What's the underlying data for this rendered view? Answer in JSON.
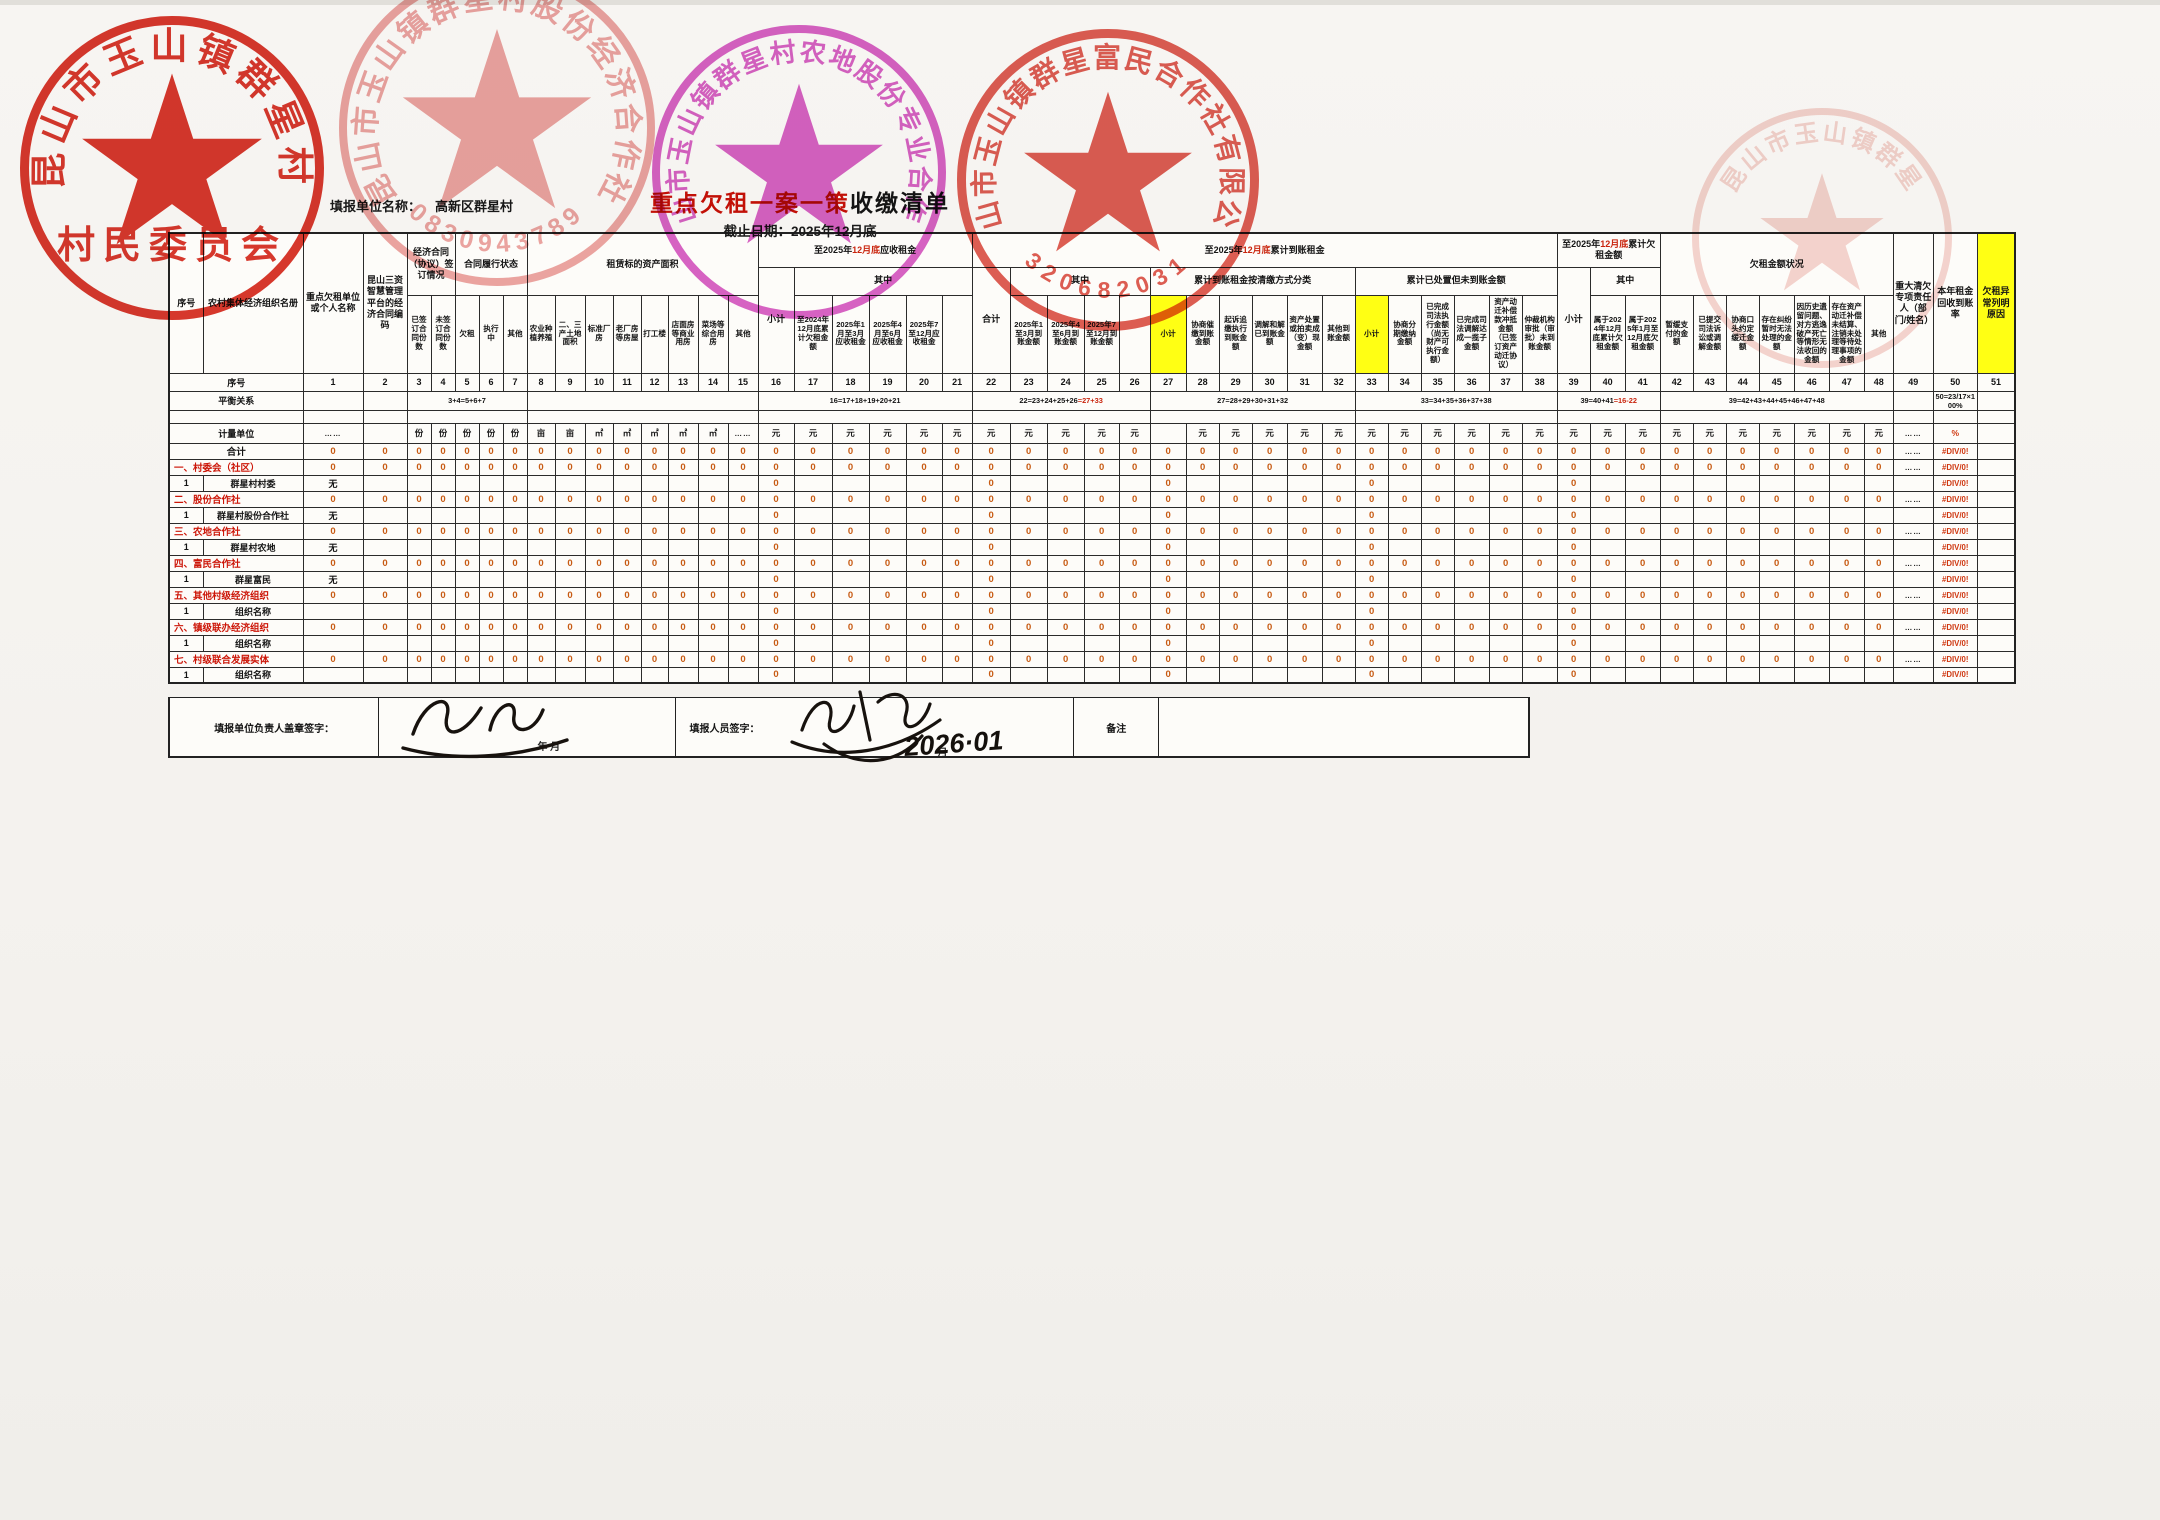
{
  "document": {
    "title_red": "重点欠租一案一策",
    "title_black": "收缴清单",
    "deadline": "截止日期：2025年12月底",
    "unit_label": "填报单位名称：",
    "unit_value": "高新区群星村"
  },
  "stamps": [
    {
      "name": "village-committee-stamp",
      "top": "昆山市玉山镇群星村",
      "bottom": "村民委员会",
      "color": "#d5281c",
      "opacity": 0.92
    },
    {
      "name": "share-cooperative-stamp",
      "top": "昆山市玉山镇群星村股份经济合作社",
      "bottom": "0830943789",
      "color": "#e06a66",
      "opacity": 0.6
    },
    {
      "name": "farmland-cooperative-stamp",
      "top": "昆山市玉山镇群星村农地股份专业合作社",
      "bottom": "",
      "color": "#cb2fb4",
      "opacity": 0.75
    },
    {
      "name": "fumin-cooperative-stamp",
      "top": "昆山市玉山镇群星富民合作社有限公司",
      "bottom": "320682031",
      "color": "#d6362a",
      "opacity": 0.8
    },
    {
      "name": "faint-partial-stamp",
      "top": "昆山市玉山镇群星",
      "bottom": "",
      "color": "#d8584a",
      "opacity": 0.25
    }
  ],
  "table": {
    "lead": [
      "序号",
      "农村集体经济组织名册"
    ],
    "row_labels": {
      "serial": "序号",
      "balance": "平衡关系",
      "units": "计量单位",
      "total": "合计"
    },
    "header_row1": [
      {
        "t": "序号",
        "rs": 3
      },
      {
        "t": "农村集体经济组织名册",
        "rs": 3
      },
      {
        "t": "重点欠租单位或个人名称",
        "rs": 3
      },
      {
        "t": "昆山三资智慧管理平台的经济合同编码",
        "rs": 3
      },
      {
        "t": "经济合同（协议）签订情况",
        "cs": 2,
        "rs": 2
      },
      {
        "t": "合同履行状态",
        "cs": 3,
        "rs": 2
      },
      {
        "t": "租赁标的资产面积",
        "cs": 8,
        "rs": 2
      },
      {
        "p": [
          [
            "至2025年",
            0
          ],
          [
            "12月底",
            1
          ],
          [
            "应收租金",
            0
          ]
        ],
        "cs": 6
      },
      {
        "p": [
          [
            "至2025年",
            0
          ],
          [
            "12月底",
            1
          ],
          [
            "累计到账租金",
            0
          ]
        ],
        "cs": 17
      },
      {
        "p": [
          [
            "至2025年",
            0
          ],
          [
            "12月底",
            1
          ],
          [
            "累计欠租金额",
            0
          ]
        ],
        "cs": 3
      },
      {
        "t": "欠租金额状况",
        "cs": 7,
        "rs": 2
      },
      {
        "t": "重大清欠专项责任人（部门/姓名）",
        "rs": 3
      },
      {
        "t": "本年租金回收到账率",
        "rs": 3
      },
      {
        "t": "欠租异常列明原因",
        "rs": 3,
        "y": 1
      }
    ],
    "header_row2": [
      {
        "t": "小计",
        "rs": 2
      },
      {
        "t": "其中",
        "cs": 5
      },
      {
        "t": "合计",
        "rs": 2
      },
      {
        "t": "其中",
        "cs": 4
      },
      {
        "t": "累计到账租金按清缴方式分类",
        "cs": 6
      },
      {
        "t": "累计已处置但未到账金额",
        "cs": 6
      },
      {
        "t": "小计",
        "rs": 2
      },
      {
        "t": "其中",
        "cs": 2
      }
    ],
    "header_row3": [
      {
        "t": "已签订合同份数"
      },
      {
        "t": "未签订合同份数"
      },
      {
        "t": "欠租"
      },
      {
        "t": "执行中"
      },
      {
        "t": "其他"
      },
      {
        "t": "农业种植养殖"
      },
      {
        "t": "二、三产土地面积"
      },
      {
        "t": "标准厂房"
      },
      {
        "t": "老厂房等房屋"
      },
      {
        "t": "打工楼"
      },
      {
        "t": "店面房等商业用房"
      },
      {
        "t": "菜场等综合用房"
      },
      {
        "t": "其他"
      },
      {
        "t": "至2024年12月底累计欠租金额"
      },
      {
        "t": "2025年1月至3月应收租金"
      },
      {
        "t": "2025年4月至6月应收租金"
      },
      {
        "t": "2025年7至12月应收租金"
      },
      {
        "t": ""
      },
      {
        "t": "2025年1至3月到账金额"
      },
      {
        "t": "2025年4至6月到账金额"
      },
      {
        "t": "2025年7至12月到账金额"
      },
      {
        "t": ""
      },
      {
        "t": "小计",
        "y": 1
      },
      {
        "t": "协商催缴到账金额"
      },
      {
        "t": "起诉追缴执行到账金额"
      },
      {
        "t": "调解和解已到账金额"
      },
      {
        "t": "资产处置或拍卖成（变）现金额"
      },
      {
        "t": "其他到账金额"
      },
      {
        "t": "小计",
        "y": 1
      },
      {
        "t": "协商分期缴纳金额"
      },
      {
        "t": "已完成司法执行金额（尚无财产可执行金额）"
      },
      {
        "t": "已完成司法调解达成一揽子金额"
      },
      {
        "t": "资产动迁补偿款冲抵金额（已签订资产动迁协议）"
      },
      {
        "t": "仲裁机构审批（审批）未到账金额"
      },
      {
        "t": "属于2024年12月底累计欠租金额"
      },
      {
        "t": "属于2025年1月至12月底欠租金额"
      },
      {
        "t": "暂缓支付的金额"
      },
      {
        "t": "已提交司法诉讼或调解金额"
      },
      {
        "t": "协商口头约定缓迁金额"
      },
      {
        "t": "存在纠纷暂时无法处理的金额"
      },
      {
        "t": "因历史遗留问题、对方逃逸破产死亡等情形无法收回的金额"
      },
      {
        "t": "存在资产动迁补偿未结算、注销未处理等待处理事项的金额"
      },
      {
        "t": "其他"
      }
    ],
    "units": [
      "……",
      "",
      "份",
      "份",
      "份",
      "份",
      "份",
      "亩",
      "亩",
      "㎡",
      "㎡",
      "㎡",
      "㎡",
      "㎡",
      "……",
      "元",
      "元",
      "元",
      "元",
      "元",
      "元",
      "元",
      "元",
      "元",
      "元",
      "元",
      "",
      "元",
      "元",
      "元",
      "元",
      "元",
      "元",
      "元",
      "元",
      "元",
      "元",
      "元",
      "元",
      "元",
      "元",
      "元",
      "元",
      "元",
      "元",
      "元",
      "元",
      "元",
      "……",
      "%",
      ""
    ],
    "balance": [
      {
        "s": 1
      },
      {
        "s": 1
      },
      {
        "s": 5,
        "b": "3+4=5+6+7"
      },
      {
        "s": 8
      },
      {
        "s": 6,
        "b": "16=17+18+19+20+21"
      },
      {
        "s": 5,
        "b": "22=23+24+25+26",
        "r": "=27+33"
      },
      {
        "s": 6,
        "b": "27=28+29+30+31+32"
      },
      {
        "s": 6,
        "b": "33=34+35+36+37+38"
      },
      {
        "s": 3,
        "b": "39=40+41",
        "r": "=16-22"
      },
      {
        "s": 7,
        "b": "39=42+43+44+45+46+47+48"
      },
      {
        "s": 1
      },
      {
        "s": 1,
        "b": "50=23/17×100%"
      },
      {
        "s": 1
      }
    ],
    "subtotal_cols": [
      16,
      22,
      27,
      33,
      39
    ],
    "zero": "0",
    "dash": "……",
    "div0": "#DIV/0!",
    "rows": [
      {
        "k": "total",
        "label": "合计"
      },
      {
        "k": "cat",
        "label": "一、村委会（社区）"
      },
      {
        "k": "sub",
        "seq": "1",
        "org": "群星村村委",
        "name": "无"
      },
      {
        "k": "cat",
        "label": "二、股份合作社"
      },
      {
        "k": "sub",
        "seq": "1",
        "org": "群星村股份合作社",
        "name": "无"
      },
      {
        "k": "cat",
        "label": "三、农地合作社"
      },
      {
        "k": "sub",
        "seq": "1",
        "org": "群星村农地",
        "name": "无"
      },
      {
        "k": "cat",
        "label": "四、富民合作社"
      },
      {
        "k": "sub",
        "seq": "1",
        "org": "群星富民",
        "name": "无"
      },
      {
        "k": "cat",
        "label": "五、其他村级经济组织"
      },
      {
        "k": "sub",
        "seq": "1",
        "org": "组织名称",
        "name": ""
      },
      {
        "k": "cat",
        "label": "六、镇级联办经济组织"
      },
      {
        "k": "sub",
        "seq": "1",
        "org": "组织名称",
        "name": ""
      },
      {
        "k": "cat",
        "label": "七、村级联合发展实体"
      },
      {
        "k": "sub",
        "seq": "1",
        "org": "组织名称",
        "name": ""
      }
    ]
  },
  "footer": {
    "label1": "填报单位负责人盖章签字：",
    "date1": "年  月",
    "label2": "填报人员签字：",
    "handwritten_date": "2026·01",
    "date2_suffix": "月",
    "note": "备注"
  }
}
